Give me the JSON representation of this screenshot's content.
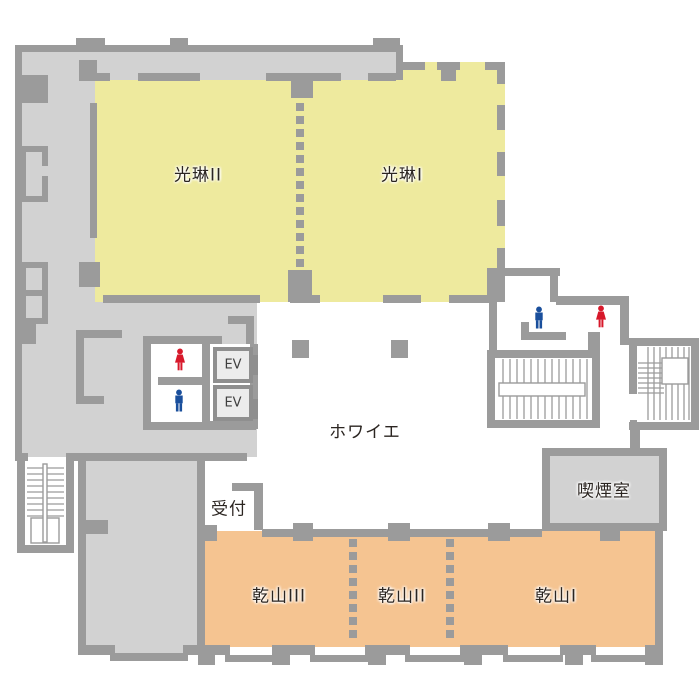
{
  "page": {
    "type": "hotel-banquet-floor-plan",
    "background": "#ffffff"
  },
  "colors": {
    "wall": "#9b9b9b",
    "corridor_fill": "#d2d2d2",
    "banquet_yellow": "#eeea9e",
    "banquet_orange": "#f5c491",
    "ev_frame": "#8f8f8f",
    "ev_fill": "#ececec",
    "man_icon_blue": "#1a4f9c",
    "woman_icon_red": "#d7182a",
    "label_text": "#2b2521"
  },
  "rooms": {
    "korin2": {
      "label": "光琳II"
    },
    "korin1": {
      "label": "光琳I"
    },
    "foyer": {
      "label": "ホワイエ"
    },
    "kenzan3": {
      "label": "乾山III"
    },
    "kenzan2": {
      "label": "乾山II"
    },
    "kenzan1": {
      "label": "乾山I"
    },
    "reception": {
      "label": "受付"
    },
    "smoking_room": {
      "label": "喫煙室"
    }
  },
  "elevators": {
    "ev1_label": "EV",
    "ev2_label": "EV"
  },
  "facilities": {
    "restroom_left": [
      "woman-icon",
      "man-icon"
    ],
    "restroom_right": [
      "man-icon",
      "woman-icon"
    ],
    "stairs": [
      "stairs-left",
      "stairs-center",
      "stairs-right"
    ]
  }
}
